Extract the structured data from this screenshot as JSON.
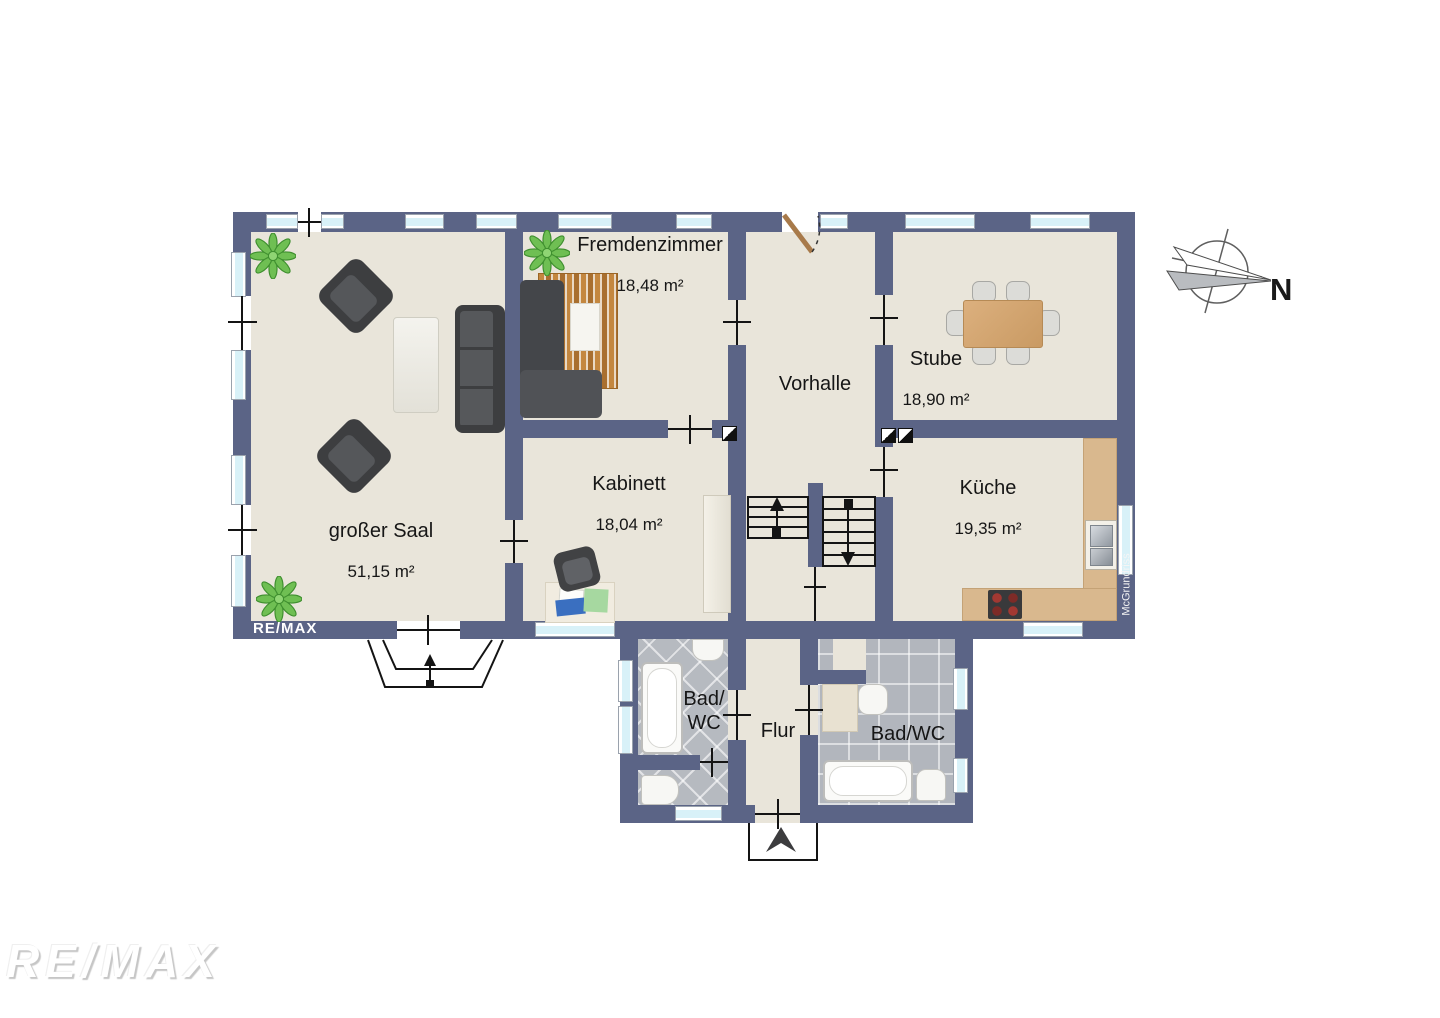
{
  "branding": {
    "wall_logo": "RE/MAX",
    "watermark": "RE/MAX",
    "credit": "McGrundriss"
  },
  "compass": {
    "label": "N"
  },
  "rooms": {
    "saal": {
      "name": "großer Saal",
      "area": "51,15 m²"
    },
    "fremdenzimmer": {
      "name": "Fremdenzimmer",
      "area": "18,48 m²"
    },
    "kabinett": {
      "name": "Kabinett",
      "area": "18,04 m²"
    },
    "vorhalle": {
      "name": "Vorhalle"
    },
    "stube": {
      "name": "Stube",
      "area": "18,90 m²"
    },
    "kueche": {
      "name": "Küche",
      "area": "19,35 m²"
    },
    "bad_links": {
      "name": "Bad/\nWC"
    },
    "flur": {
      "name": "Flur"
    },
    "bad_rechts": {
      "name": "Bad/WC"
    }
  },
  "colors": {
    "wall": "#5b6486",
    "floor": "#e9e5da",
    "window_glass": "#d8f1f8",
    "tile": "#b5b9bf",
    "counter_wood": "#d9b88e",
    "table_wood": "#d2a370",
    "furniture_dark": "#3d3e40",
    "plant_green": "#6fbf53"
  }
}
